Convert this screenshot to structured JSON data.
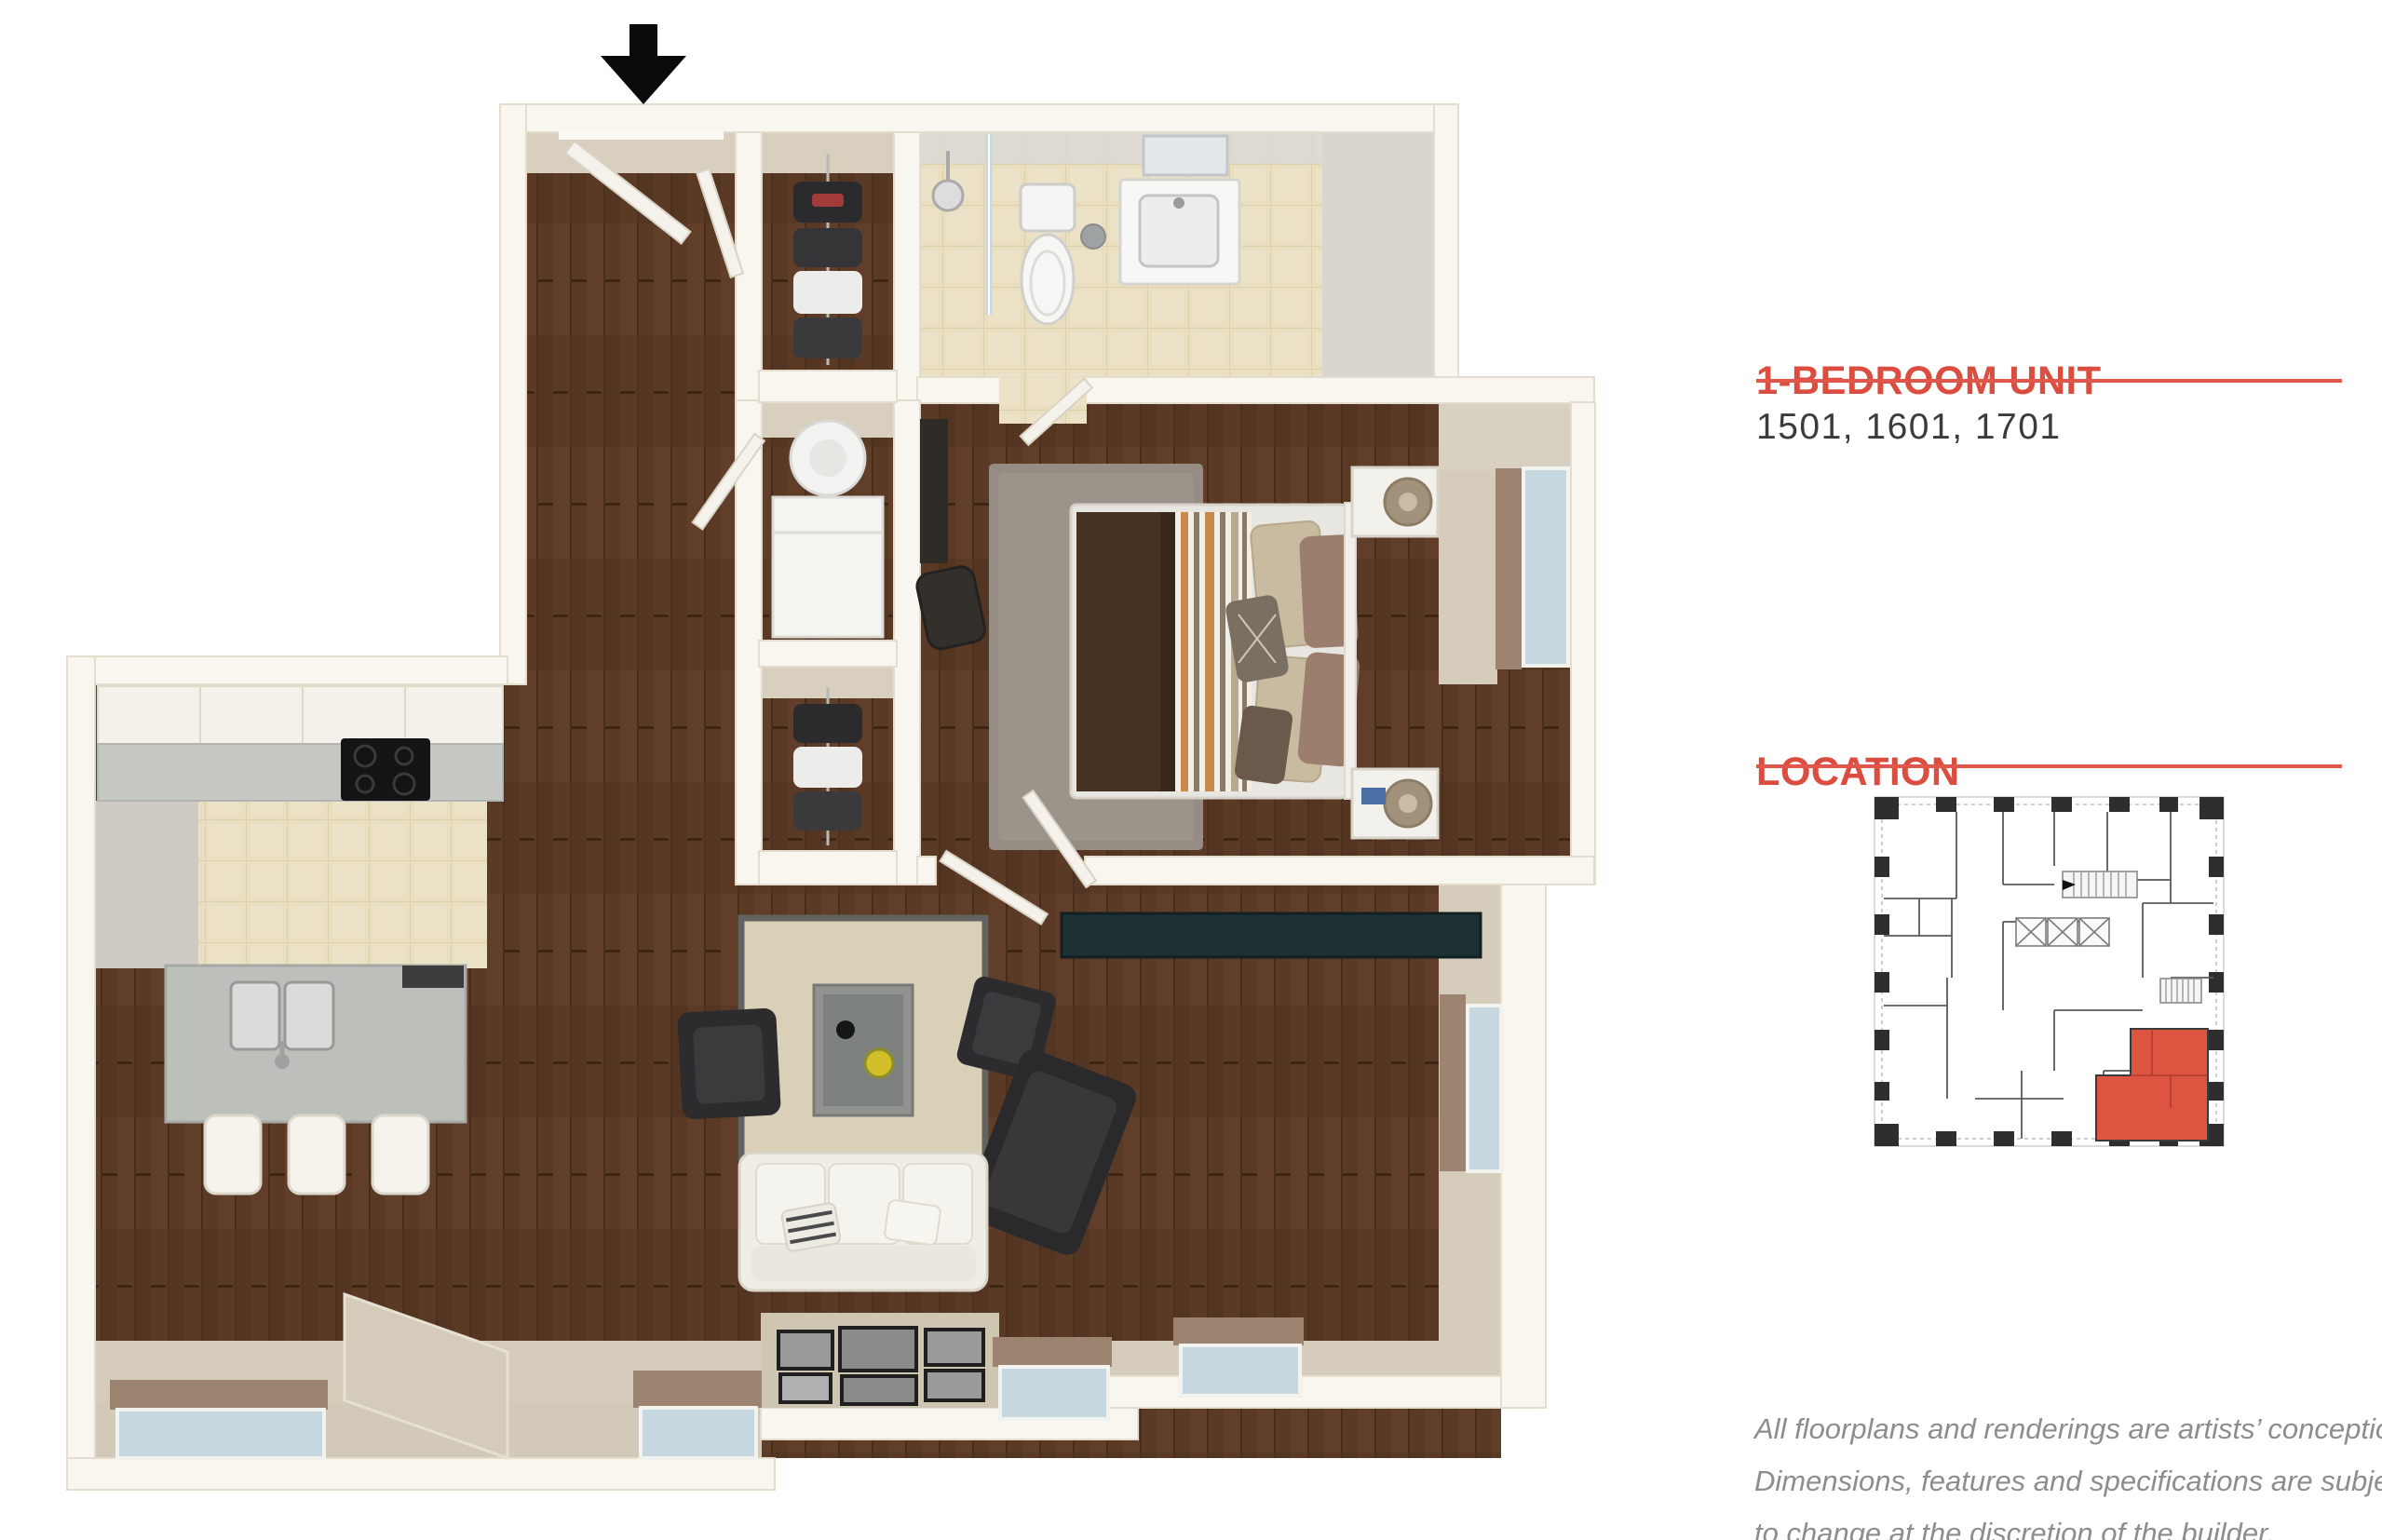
{
  "header": {
    "unit_type_label": "1-BEDROOM UNIT",
    "unit_numbers": "1501, 1601, 1701"
  },
  "location": {
    "section_label": "LOCATION"
  },
  "disclaimer": {
    "line1": "All floorplans and renderings are artists’ conception.",
    "line2": "Dimensions, features and specifications are subject",
    "line3": "to change at the discretion of the builder."
  },
  "colors": {
    "accent": "#DB4E3F",
    "rule": "#E0564A",
    "unit_highlight": "#DD5440",
    "body_text": "#3B3B3B",
    "disclaimer_text": "#8D8D8D",
    "wood_floor": "#5B3A25",
    "tile_floor": "#EADEC1",
    "outer_wall": "#F9F6F0",
    "inner_wall_beige": "#D5CCBC",
    "window_glass": "#C7D7E0",
    "window_sill_marble": "#9C8470",
    "media_console": "#1E3134",
    "living_rug": "#D9D0B7",
    "bedroom_rug": "#958C83"
  },
  "floorplan": {
    "entry_marker": "entry-arrow",
    "rooms": [
      "entry",
      "hallway",
      "closet",
      "laundry-closet",
      "bathroom",
      "bedroom",
      "kitchen",
      "living-room"
    ]
  }
}
